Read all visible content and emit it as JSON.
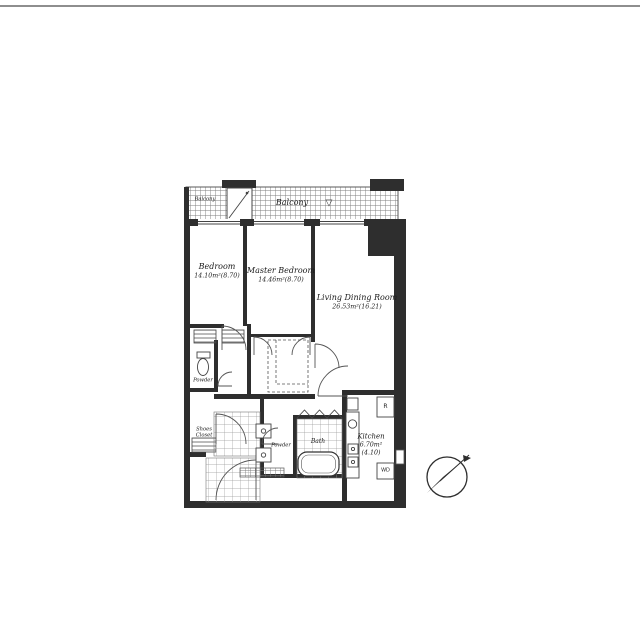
{
  "page": {
    "background": "#ffffff",
    "top_rule_color": "#8e8e8e"
  },
  "plan": {
    "wall_color": "#2e2e2e",
    "balcony": {
      "label": "Balcony",
      "label_small": "Balcony",
      "mark": "▽"
    },
    "rooms": {
      "bedroom": {
        "name": "Bedroom",
        "area": "14.10m²(8.70)"
      },
      "master_bedroom": {
        "name": "Master Bedroom",
        "area": "14.46m²(8.70)"
      },
      "living_dining": {
        "name": "Living Dining Room",
        "area": "26.53m²(16.21)"
      },
      "kitchen": {
        "name": "Kitchen",
        "area": "6.70m²",
        "tatami": "(4.10)"
      },
      "powder_wc": {
        "name": "Powder"
      },
      "powder_vanity": {
        "name": "Powder"
      },
      "bath": {
        "name": "Bath"
      },
      "shoes_closet": {
        "line1": "Shoes",
        "line2": "Closet"
      }
    },
    "appliances": {
      "refrigerator": "R",
      "washer_dryer": "WD"
    }
  }
}
